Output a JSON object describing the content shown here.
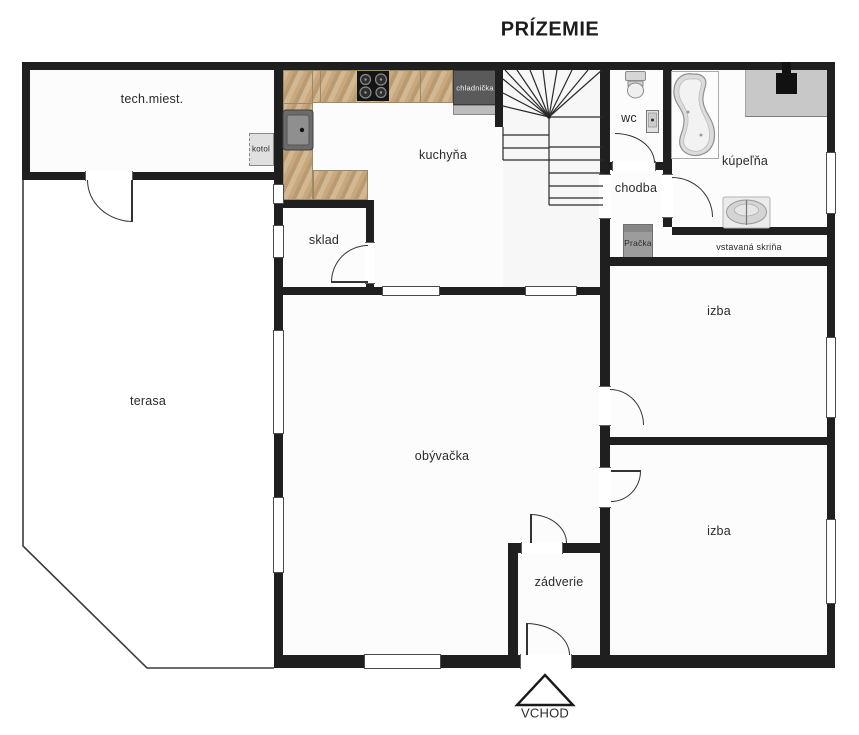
{
  "title": "PRÍZEMIE",
  "rooms": {
    "tech": "tech.miest.",
    "kitchen": "kuchyňa",
    "storage": "sklad",
    "wc": "wc",
    "bathroom": "kúpeľňa",
    "hallway": "chodba",
    "closet": "vstavaná skriňa",
    "room_top": "izba",
    "room_bottom": "izba",
    "terrace": "terasa",
    "living_room": "obývačka",
    "vestibule": "zádverie"
  },
  "appliances": {
    "fridge": "chladnička",
    "boiler": "kotol",
    "washing_machine": "Pračka"
  },
  "entrance_label": "VCHOD",
  "colors": {
    "wall": "#1f1f1f",
    "counter_wood": "#c9a87d",
    "fridge_body": "#5a5a5a",
    "washer_gray": "#9c9c9c",
    "bath_counter": "#c8c8c8",
    "floor": "#fcfcfc"
  }
}
